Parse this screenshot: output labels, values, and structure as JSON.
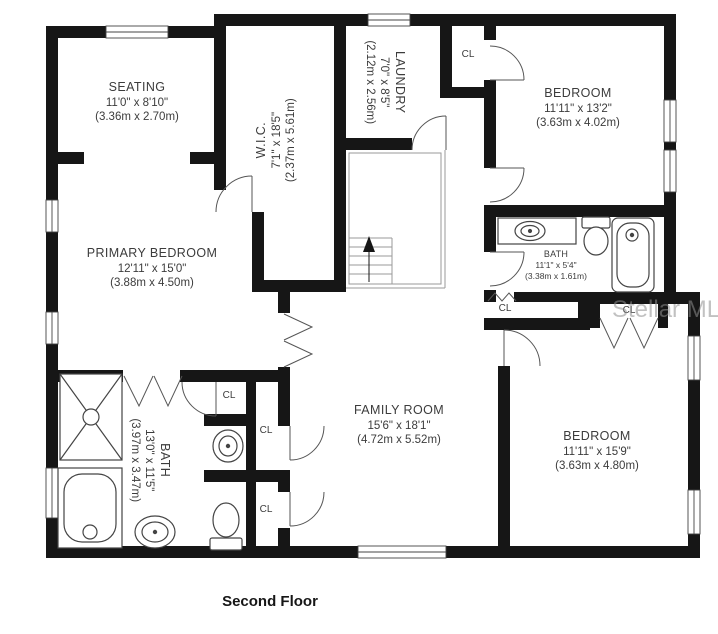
{
  "floor_title": "Second Floor",
  "watermark": "Stellar MLS",
  "closet_label": "CL",
  "colors": {
    "wall": "#161616",
    "text": "#3c3c3c",
    "door": "#555555",
    "fixture": "#444444",
    "watermark": "#8f8f8f"
  },
  "rooms": [
    {
      "name": "SEATING",
      "dims": "11'0\" x 8'10\"",
      "metric": "(3.36m x 2.70m)"
    },
    {
      "name": "W.I.C.",
      "dims": "7'1\" x 18'5\"",
      "metric": "(2.37m x 5.61m)"
    },
    {
      "name": "LAUNDRY",
      "dims": "7'0\" x 8'5\"",
      "metric": "(2.12m x 2.56m)"
    },
    {
      "name": "BEDROOM",
      "dims": "11'11\" x 13'2\"",
      "metric": "(3.63m x 4.02m)"
    },
    {
      "name": "PRIMARY BEDROOM",
      "dims": "12'11\" x 15'0\"",
      "metric": "(3.88m x 4.50m)"
    },
    {
      "name": "BATH",
      "dims": "11'1\" x 5'4\"",
      "metric": "(3.38m x 1.61m)"
    },
    {
      "name": "FAMILY ROOM",
      "dims": "15'6\" x 18'1\"",
      "metric": "(4.72m x 5.52m)"
    },
    {
      "name": "BEDROOM",
      "dims": "11'11\" x 15'9\"",
      "metric": "(3.63m x 4.80m)"
    },
    {
      "name": "BATH",
      "dims": "13'0\" x 11'5\"",
      "metric": "(3.97m x 3.47m)"
    }
  ]
}
